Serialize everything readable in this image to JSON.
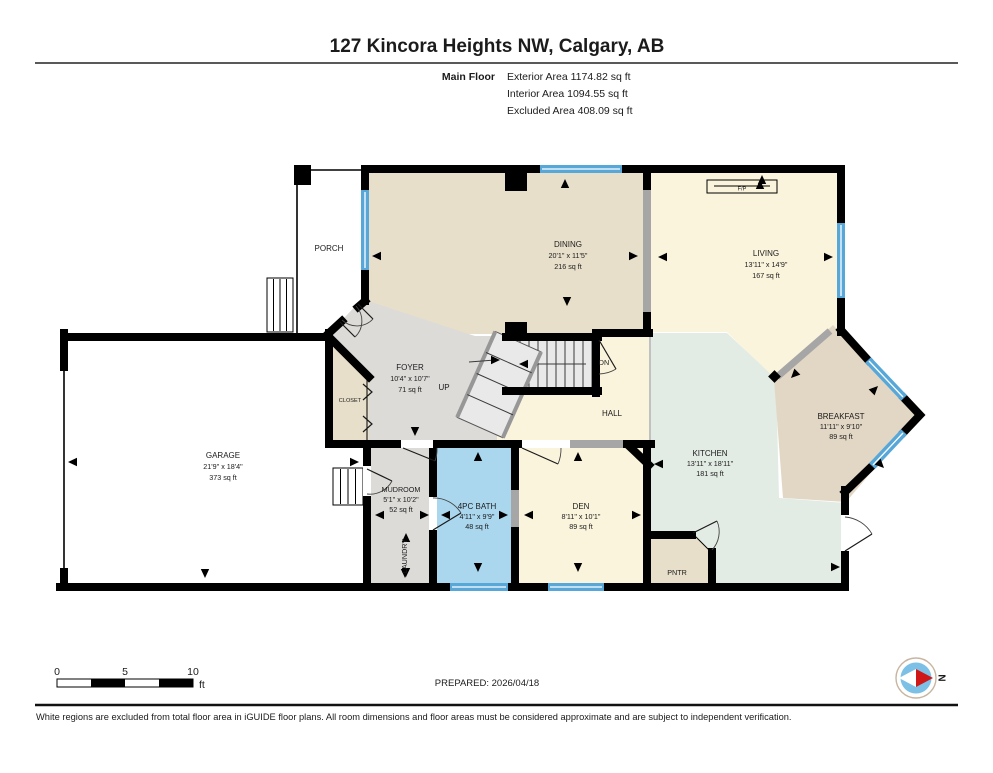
{
  "header": {
    "title": "127 Kincora Heights NW, Calgary, AB",
    "floor_label": "Main Floor",
    "area_lines": [
      "Exterior Area 1174.82 sq ft",
      "Interior Area 1094.55 sq ft",
      "Excluded Area 408.09 sq ft"
    ]
  },
  "rooms": {
    "porch": {
      "name": "PORCH"
    },
    "dining": {
      "name": "DINING",
      "dims": "20'1\" x 11'5\"",
      "area": "216 sq ft"
    },
    "living": {
      "name": "LIVING",
      "dims": "13'11\" x 14'9\"",
      "area": "167 sq ft"
    },
    "foyer": {
      "name": "FOYER",
      "dims": "10'4\" x 10'7\"",
      "area": "71 sq ft"
    },
    "garage": {
      "name": "GARAGE",
      "dims": "21'9\" x 18'4\"",
      "area": "373 sq ft"
    },
    "mudroom": {
      "name": "MUDROOM",
      "dims": "5'1\" x 10'2\"",
      "area": "52 sq ft"
    },
    "bath": {
      "name": "4PC BATH",
      "dims": "4'11\" x 9'9\"",
      "area": "48 sq ft"
    },
    "den": {
      "name": "DEN",
      "dims": "8'11\" x 10'1\"",
      "area": "89 sq ft"
    },
    "kitchen": {
      "name": "KITCHEN",
      "dims": "13'11\" x 18'11\"",
      "area": "181 sq ft"
    },
    "breakfast": {
      "name": "BREAKFAST",
      "dims": "11'11\" x 9'10\"",
      "area": "89 sq ft"
    }
  },
  "labels": {
    "closet": "CLOSET",
    "laundry": "LAUNDRY",
    "hall": "HALL",
    "pantry": "PNTR",
    "fireplace": "F/P",
    "up": "UP",
    "down": "DN"
  },
  "scale_bar": {
    "ticks": [
      "0",
      "5",
      "10"
    ],
    "unit": "ft"
  },
  "footer": {
    "prepared": "PREPARED: 2026/04/18",
    "disclaimer": "White regions are excluded from total floor area in iGUIDE floor plans. All room dimensions and floor areas must be considered approximate and are subject to independent verification.",
    "compass_label": "N"
  },
  "colors": {
    "wall": "#000000",
    "window_blue": "#57a7d8",
    "opening_grey": "#a6a6a6",
    "floor_tan": "#e7dfca",
    "floor_tan_dark": "#e2d7c5",
    "floor_yellow": "#faf4dd",
    "floor_grey": "#dcdbd8",
    "floor_blue": "#aad7ee",
    "floor_green": "#e2ebe4",
    "stair_fill": "#e9e9e9",
    "compass_blue": "#7cc0e6",
    "compass_red": "#cf1717"
  }
}
